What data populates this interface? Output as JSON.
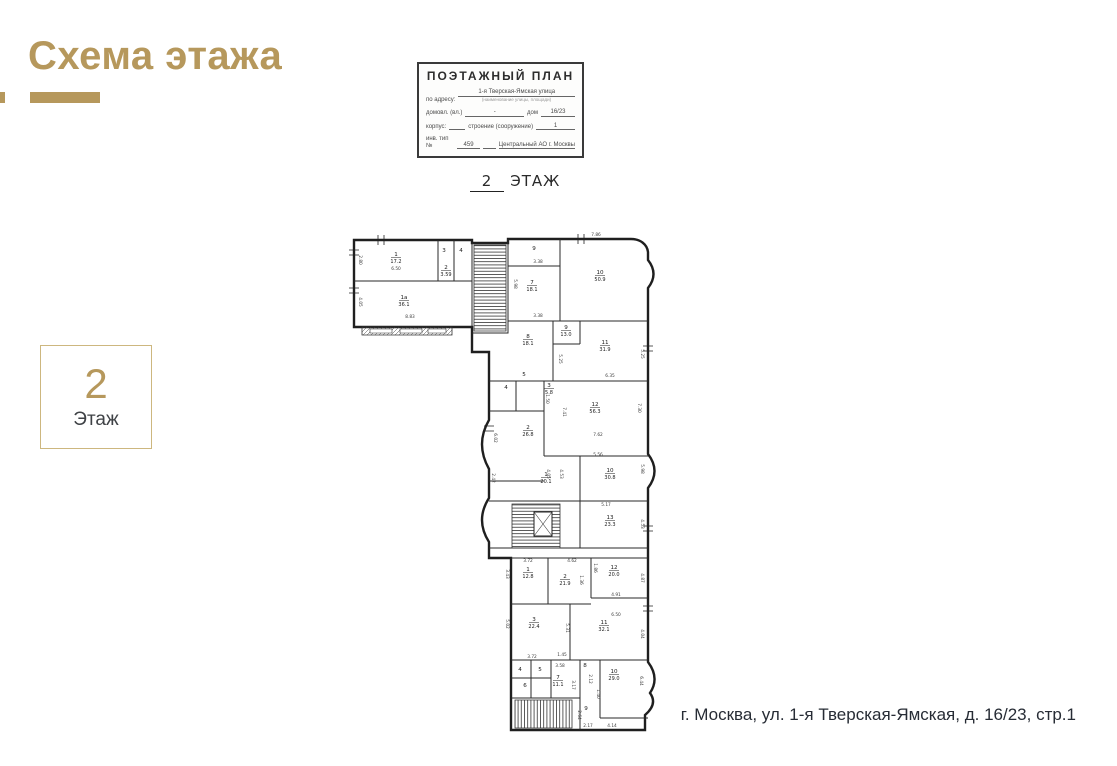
{
  "header": {
    "title": "Схема этажа",
    "accent_color": "#b6985c"
  },
  "floor_badge": {
    "number": "2",
    "label": "Этаж"
  },
  "stamp": {
    "title": "ПОЭТАЖНЫЙ ПЛАН",
    "row1_label": "по адресу:",
    "row1_value": "1-я Тверская-Ямская улица",
    "row1_caption": "(наименование улицы, площади)",
    "row2_label": "домовл. (вл.)",
    "row2_dash": "-",
    "row2_label2": "дом",
    "row2_value": "16/23",
    "row3_label": "корпус:",
    "row3_label2": "строение (сооружение)",
    "row3_value": "1",
    "row4_label": "инв. тип №",
    "row4_value": "459",
    "row4_value2": "Центральный АО г. Москвы"
  },
  "plan_heading": {
    "number": "2",
    "label": "ЭТАЖ"
  },
  "address": "г. Москва, ул. 1-я Тверская-Ямская, д. 16/23, стр.1",
  "plan": {
    "rooms": [
      {
        "n": "1",
        "a": "17.2",
        "x": 48,
        "y": 30
      },
      {
        "n": "3",
        "a": "",
        "x": 96,
        "y": 26
      },
      {
        "n": "4",
        "a": "",
        "x": 113,
        "y": 26
      },
      {
        "n": "2",
        "a": "3.59",
        "x": 98,
        "y": 43
      },
      {
        "n": "1а",
        "a": "36.1",
        "x": 56,
        "y": 73
      },
      {
        "n": "9",
        "a": "",
        "x": 186,
        "y": 24
      },
      {
        "n": "7",
        "a": "18.1",
        "x": 184,
        "y": 58
      },
      {
        "n": "10",
        "a": "50.9",
        "x": 252,
        "y": 48
      },
      {
        "n": "8",
        "a": "18.1",
        "x": 180,
        "y": 112
      },
      {
        "n": "9",
        "a": "13.0",
        "x": 218,
        "y": 103
      },
      {
        "n": "11",
        "a": "31.9",
        "x": 257,
        "y": 118
      },
      {
        "n": "4",
        "a": "",
        "x": 158,
        "y": 163
      },
      {
        "n": "5",
        "a": "",
        "x": 176,
        "y": 150
      },
      {
        "n": "3",
        "a": "5.8",
        "x": 201,
        "y": 161
      },
      {
        "n": "2",
        "a": "26.8",
        "x": 180,
        "y": 203
      },
      {
        "n": "12",
        "a": "56.3",
        "x": 247,
        "y": 180
      },
      {
        "n": "1",
        "a": "20.1",
        "x": 198,
        "y": 250
      },
      {
        "n": "10",
        "a": "30.8",
        "x": 262,
        "y": 246
      },
      {
        "n": "13",
        "a": "23.3",
        "x": 262,
        "y": 293
      },
      {
        "n": "1",
        "a": "12.8",
        "x": 180,
        "y": 345
      },
      {
        "n": "2",
        "a": "21.9",
        "x": 217,
        "y": 352
      },
      {
        "n": "12",
        "a": "20.0",
        "x": 266,
        "y": 343
      },
      {
        "n": "3",
        "a": "22.4",
        "x": 186,
        "y": 395
      },
      {
        "n": "11",
        "a": "32.1",
        "x": 256,
        "y": 398
      },
      {
        "n": "4",
        "a": "",
        "x": 172,
        "y": 445
      },
      {
        "n": "5",
        "a": "",
        "x": 192,
        "y": 445
      },
      {
        "n": "6",
        "a": "",
        "x": 177,
        "y": 461
      },
      {
        "n": "7",
        "a": "11.1",
        "x": 210,
        "y": 453
      },
      {
        "n": "8",
        "a": "",
        "x": 237,
        "y": 441
      },
      {
        "n": "9",
        "a": "",
        "x": 238,
        "y": 484
      },
      {
        "n": "10",
        "a": "29.0",
        "x": 266,
        "y": 447
      }
    ],
    "dims": [
      {
        "t": "7.86",
        "x": 248,
        "y": 10,
        "r": 0
      },
      {
        "t": "2.80",
        "x": 11,
        "y": 34,
        "r": 90
      },
      {
        "t": "6.50",
        "x": 48,
        "y": 44,
        "r": 0
      },
      {
        "t": "4.05",
        "x": 11,
        "y": 76,
        "r": 90
      },
      {
        "t": "8.83",
        "x": 62,
        "y": 92,
        "r": 0
      },
      {
        "t": "3.38",
        "x": 190,
        "y": 37,
        "r": 0
      },
      {
        "t": "3.38",
        "x": 190,
        "y": 91,
        "r": 0
      },
      {
        "t": "5.98",
        "x": 166,
        "y": 58,
        "r": 90
      },
      {
        "t": "5.25",
        "x": 211,
        "y": 133,
        "r": 90
      },
      {
        "t": "5.25",
        "x": 293,
        "y": 128,
        "r": 90
      },
      {
        "t": "6.35",
        "x": 262,
        "y": 151,
        "r": 0
      },
      {
        "t": "1.50",
        "x": 198,
        "y": 173,
        "r": 90
      },
      {
        "t": "7.41",
        "x": 215,
        "y": 186,
        "r": 90
      },
      {
        "t": "7.30",
        "x": 290,
        "y": 182,
        "r": 90
      },
      {
        "t": "7.62",
        "x": 250,
        "y": 210,
        "r": 0
      },
      {
        "t": "6.02",
        "x": 146,
        "y": 212,
        "r": 90
      },
      {
        "t": "5.56",
        "x": 250,
        "y": 230,
        "r": 0
      },
      {
        "t": "5.98",
        "x": 293,
        "y": 243,
        "r": 90
      },
      {
        "t": "4.05",
        "x": 199,
        "y": 248,
        "r": 90
      },
      {
        "t": "4.53",
        "x": 212,
        "y": 248,
        "r": 90
      },
      {
        "t": "2.42",
        "x": 144,
        "y": 252,
        "r": 90
      },
      {
        "t": "5.17",
        "x": 258,
        "y": 280,
        "r": 0
      },
      {
        "t": "4.53",
        "x": 293,
        "y": 298,
        "r": 90
      },
      {
        "t": "3.72",
        "x": 180,
        "y": 336,
        "r": 0
      },
      {
        "t": "3.43",
        "x": 158,
        "y": 348,
        "r": 90
      },
      {
        "t": "4.62",
        "x": 224,
        "y": 336,
        "r": 0
      },
      {
        "t": "1.86",
        "x": 246,
        "y": 342,
        "r": 90
      },
      {
        "t": "1.36",
        "x": 232,
        "y": 354,
        "r": 90
      },
      {
        "t": "4.87",
        "x": 293,
        "y": 352,
        "r": 90
      },
      {
        "t": "4.91",
        "x": 268,
        "y": 370,
        "r": 0
      },
      {
        "t": "6.50",
        "x": 268,
        "y": 390,
        "r": 0
      },
      {
        "t": "5.02",
        "x": 158,
        "y": 398,
        "r": 90
      },
      {
        "t": "5.31",
        "x": 218,
        "y": 402,
        "r": 90
      },
      {
        "t": "4.04",
        "x": 293,
        "y": 408,
        "r": 90
      },
      {
        "t": "3.72",
        "x": 184,
        "y": 432,
        "r": 0
      },
      {
        "t": "1.45",
        "x": 214,
        "y": 430,
        "r": 0
      },
      {
        "t": "3.58",
        "x": 212,
        "y": 441,
        "r": 0
      },
      {
        "t": "3.17",
        "x": 224,
        "y": 459,
        "r": 90
      },
      {
        "t": "2.12",
        "x": 241,
        "y": 453,
        "r": 90
      },
      {
        "t": "1.40",
        "x": 249,
        "y": 468,
        "r": 90
      },
      {
        "t": "2.64",
        "x": 230,
        "y": 489,
        "r": 90
      },
      {
        "t": "2.17",
        "x": 240,
        "y": 501,
        "r": 0
      },
      {
        "t": "6.44",
        "x": 292,
        "y": 455,
        "r": 90
      },
      {
        "t": "4.14",
        "x": 264,
        "y": 501,
        "r": 0
      }
    ]
  }
}
